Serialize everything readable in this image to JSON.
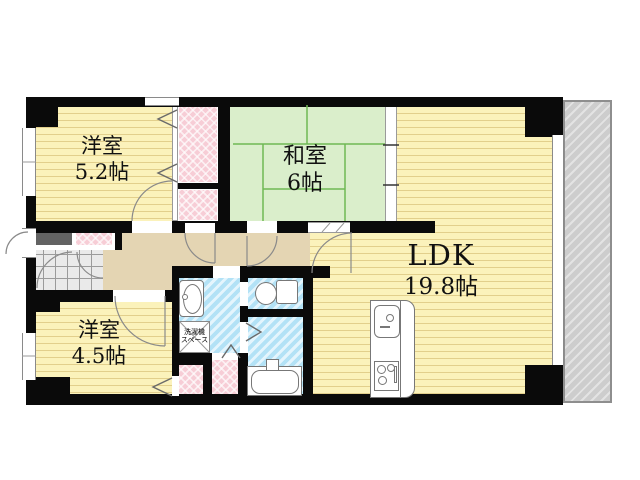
{
  "floorplan": {
    "kind": "japanese-apartment-floor-plan",
    "rooms": {
      "bedroom1": {
        "name": "洋室",
        "size": "5.2帖"
      },
      "washitsu": {
        "name": "和室",
        "size": "6帖"
      },
      "ldk": {
        "name": "LDK",
        "size": "19.8帖"
      },
      "bedroom2": {
        "name": "洋室",
        "size": "4.5帖"
      },
      "laundry": {
        "line1": "洗濯機",
        "line2": "スペース"
      }
    },
    "colors": {
      "flooring": "#fbf2bb",
      "tatami": "#daeecb",
      "closet_pink": "#f7cdd6",
      "wet_blue": "#b3e2f6",
      "hallway_tan": "#e4d5b3",
      "balcony_gray": "#cdcdcd",
      "wall_black": "#0a0a0a"
    }
  }
}
